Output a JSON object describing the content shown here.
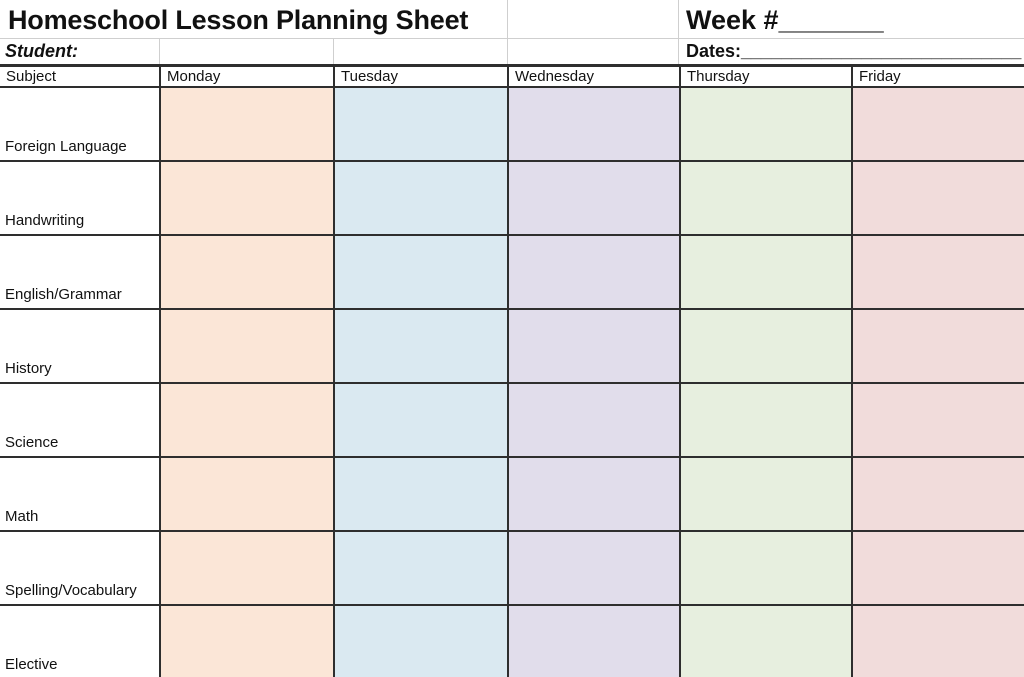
{
  "header": {
    "title": "Homeschool Lesson Planning Sheet",
    "week_label": "Week #",
    "week_line": "_______",
    "student_label": "Student:",
    "dates_label": "Dates:",
    "dates_line": "____________________________"
  },
  "table": {
    "subject_header": "Subject",
    "days": [
      {
        "label": "Monday",
        "color": "#FBE6D7"
      },
      {
        "label": "Tuesday",
        "color": "#DAE9F1"
      },
      {
        "label": "Wednesday",
        "color": "#E1DDEB"
      },
      {
        "label": "Thursday",
        "color": "#E7EFDF"
      },
      {
        "label": "Friday",
        "color": "#F1DCDB"
      }
    ],
    "subjects": [
      "Foreign Language",
      "Handwriting",
      "English/Grammar",
      "History",
      "Science",
      "Math",
      "Spelling/Vocabulary",
      "Elective"
    ]
  }
}
